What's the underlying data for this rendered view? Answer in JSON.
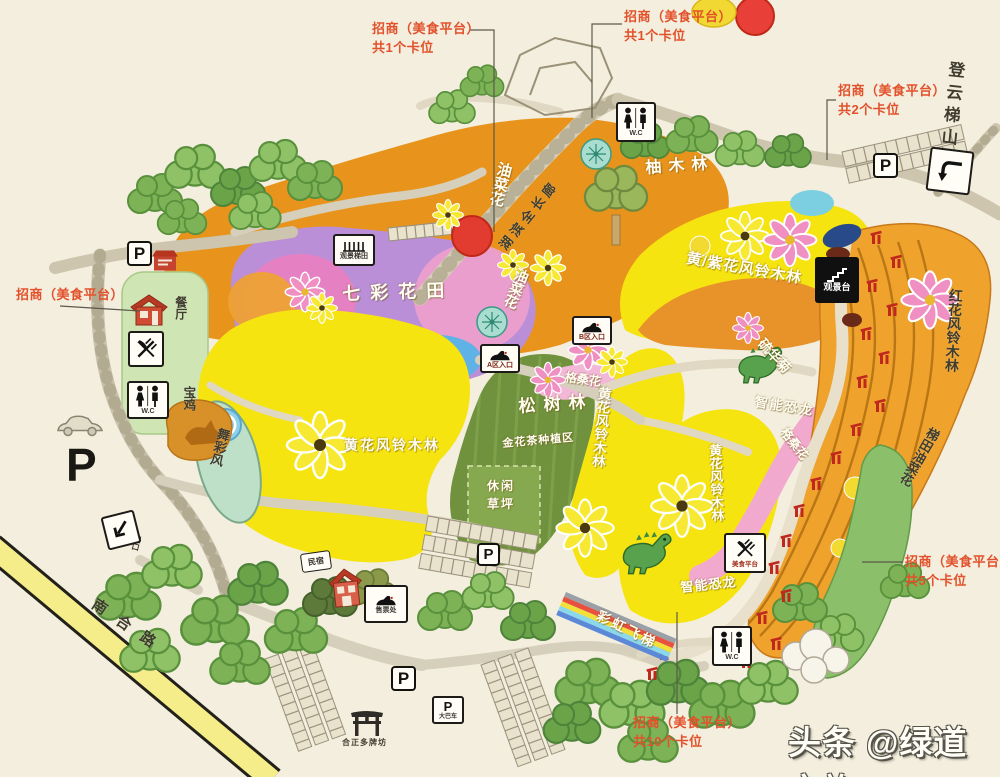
{
  "annotations": {
    "top_left": {
      "line1": "招商（美食平台）",
      "line2": "共1个卡位"
    },
    "top_mid": {
      "line1": "招商（美食平台）",
      "line2": "共1个卡位"
    },
    "top_right": {
      "line1": "招商（美食平台）",
      "line2": "共2个卡位"
    },
    "left": {
      "line1": "招商（美食平台）"
    },
    "right": {
      "line1": "招商（美食平台）",
      "line2": "共5个卡位"
    },
    "bottom": {
      "line1": "招商（美食平台）",
      "line2": "共10个卡位"
    }
  },
  "areas": {
    "rapeseed_1": "油菜花",
    "rapeseed_2": "油菜花",
    "colorful_flower_field": "七彩花田",
    "teak_forest": "柚木林",
    "lakeside_corridor": "湖滨全长廊",
    "yellow_purple_trumpet": "黄/紫花风铃木林",
    "red_trumpet": "红花风铃木林",
    "sulfur_cosmos": "硫华菊",
    "gesang_1": "格桑花",
    "gesang_2": "格桑花",
    "pine_forest": "松树林",
    "camellia_zone": "金花茶种植区",
    "leisure_lawn": "休闲草坪",
    "yellow_trumpet_1": "黄花风铃木林",
    "yellow_trumpet_2": "黄花风铃木林",
    "yellow_trumpet_3": "黄花风铃木林",
    "smart_dino_1": "智能恐龙",
    "smart_dino_2": "智能恐龙",
    "rainbow_ladder": "彩虹飞梯",
    "terrace_rapeseed": "梯田油菜花",
    "wind_dance": "舞彩风",
    "treasure_rooster": "宝鸡",
    "dengyun_ladder": "登云梯山"
  },
  "facilities": {
    "viewing_terrace": "观景梯田",
    "viewing_deck": "观景台",
    "restaurant": "餐厅",
    "homestay": "民宿",
    "ticket_office": "售票处",
    "food_platform": "美食平台",
    "entry_a": "A区入口",
    "entry_b": "B区入口",
    "wc": "W.C",
    "parking": "P",
    "bus_parking": "大巴车",
    "exit_gate": "出口",
    "archway": "合正多牌坊",
    "road_name": "南合路"
  },
  "watermark": {
    "text": "头条 @绿道文旅"
  },
  "colors": {
    "annotation_red": "#e2512b",
    "rapeseed_orange": "#e8941c",
    "trumpet_yellow": "#f6e410",
    "field_purple": "#bb8fd8",
    "field_pink": "#ec92c6",
    "lake_blue": "#5fb2e6",
    "pine_green": "#70923e",
    "terrace_orange": "#efa32c",
    "road_grey": "#cdc5ae",
    "tree_green": "#7db356"
  }
}
